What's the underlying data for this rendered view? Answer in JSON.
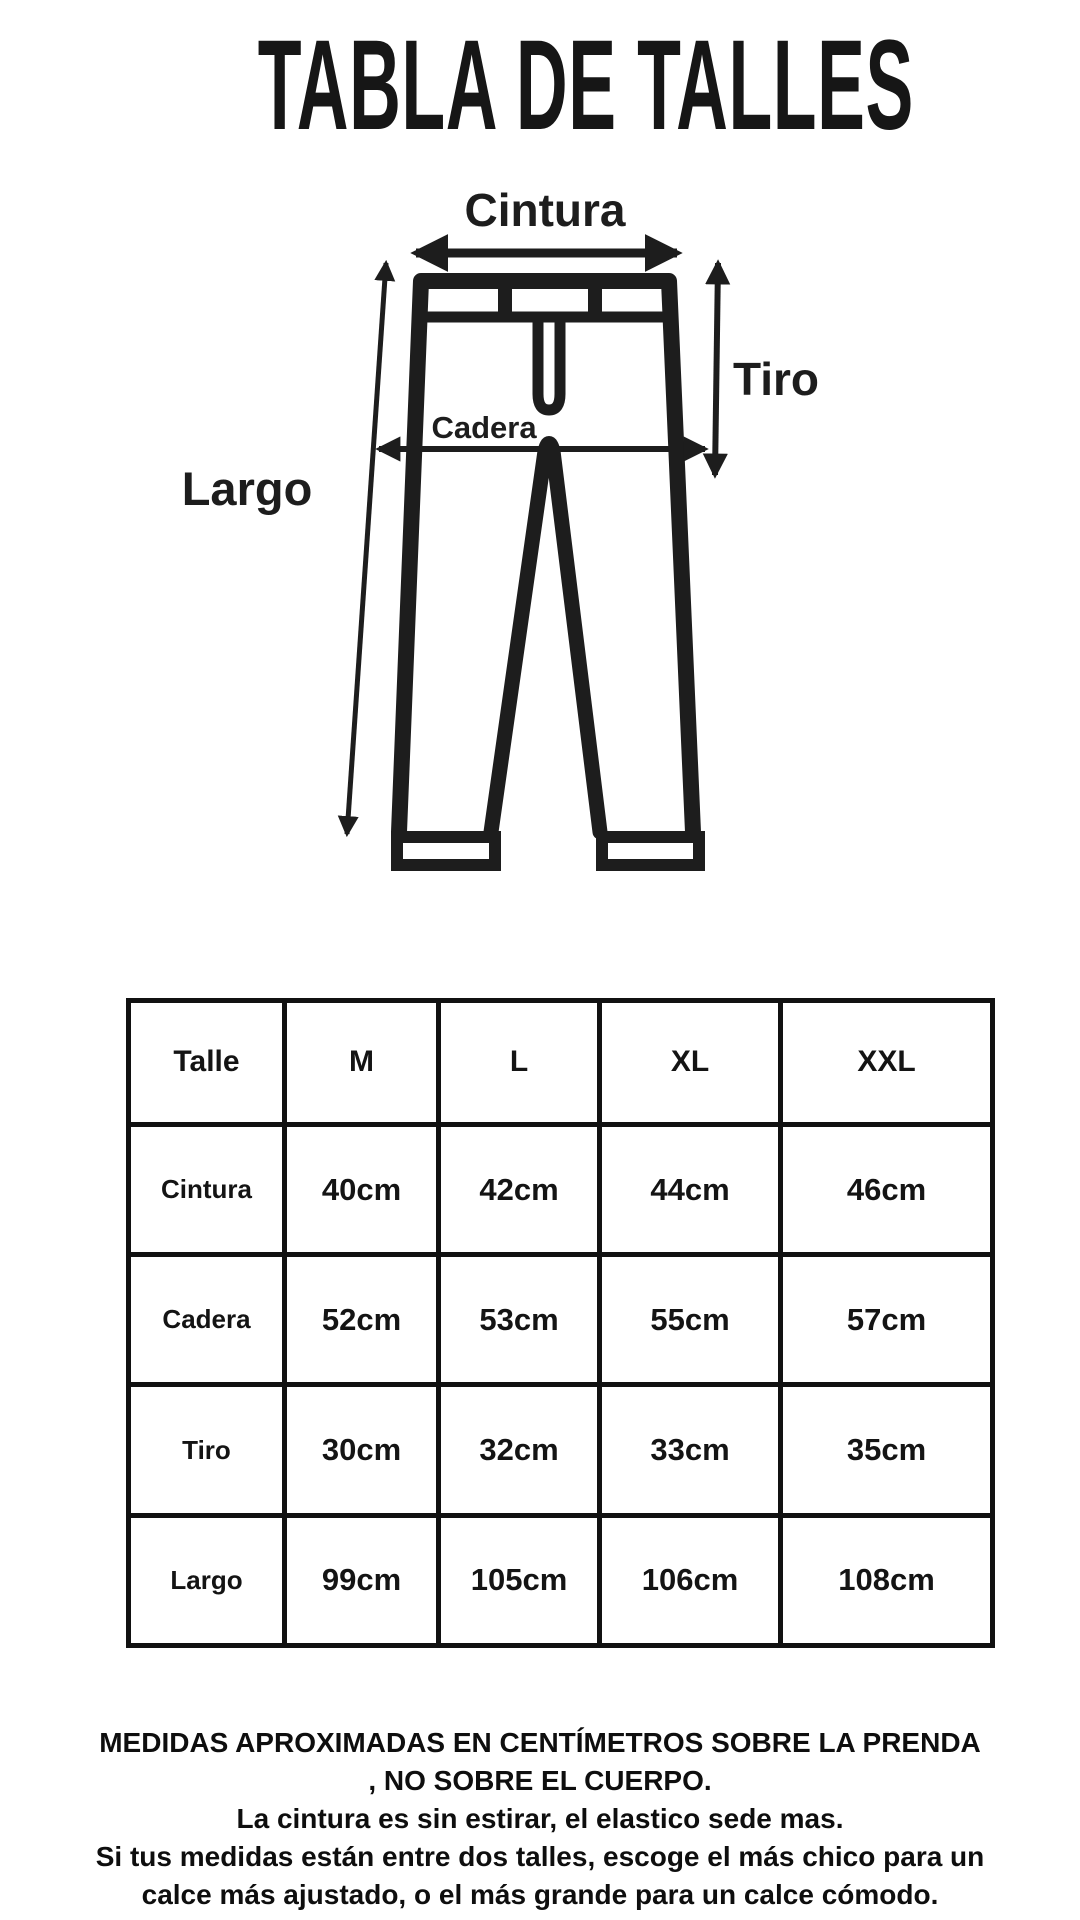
{
  "title": "TABLA DE TALLES",
  "diagram": {
    "labels": {
      "cintura": "Cintura",
      "tiro": "Tiro",
      "cadera": "Cadera",
      "largo": "Largo"
    }
  },
  "table": {
    "columns": [
      "Talle",
      "M",
      "L",
      "XL",
      "XXL"
    ],
    "rows": [
      {
        "label": "Cintura",
        "values": [
          "40cm",
          "42cm",
          "44cm",
          "46cm"
        ]
      },
      {
        "label": "Cadera",
        "values": [
          "52cm",
          "53cm",
          "55cm",
          "57cm"
        ]
      },
      {
        "label": "Tiro",
        "values": [
          "30cm",
          "32cm",
          "33cm",
          "35cm"
        ]
      },
      {
        "label": "Largo",
        "values": [
          "99cm",
          "105cm",
          "106cm",
          "108cm"
        ]
      }
    ]
  },
  "footer": {
    "lines": [
      "MEDIDAS APROXIMADAS EN CENTÍMETROS SOBRE LA PRENDA",
      ", NO SOBRE EL CUERPO.",
      "La cintura es sin estirar, el elastico sede mas.",
      "Si tus medidas están entre dos talles, escoge el más chico para un",
      "calce más ajustado, o el más grande para un calce cómodo."
    ]
  },
  "colors": {
    "ink": "#1d1d1d",
    "background": "#ffffff"
  }
}
